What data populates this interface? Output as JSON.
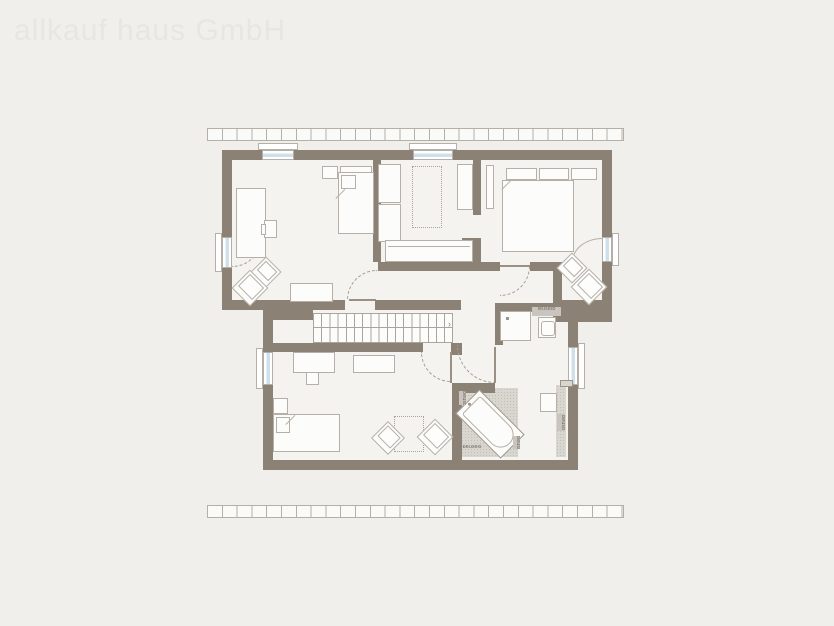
{
  "watermark": {
    "text": "allkauf haus GmbH"
  },
  "stairs": {
    "arrow": "›"
  },
  "labels": {
    "bath_top_box": "leuseib",
    "tile_left": "beusb",
    "tile_corner": "beusb",
    "tile_right": "beusb",
    "tile_bottom": "beusels"
  },
  "colors": {
    "background": "#f0efec",
    "wall": "#8b8174",
    "outline": "#b5afa7",
    "floor": "#f4f3f0",
    "tile": "#d9d6d0",
    "glazing": "#cfe0ea",
    "watermark": "#e7e6e2",
    "label_text": "#6f6860"
  }
}
